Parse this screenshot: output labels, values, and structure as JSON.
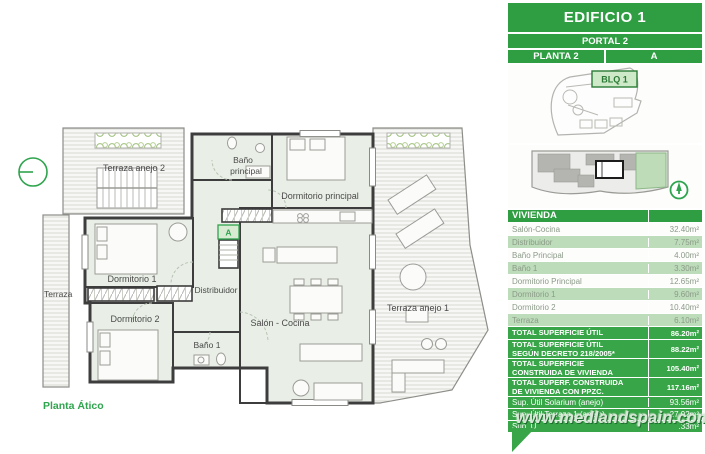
{
  "watermark": "www.medlandspain.com",
  "plan": {
    "title": "Planta Ático",
    "labels": {
      "terraza_anejo_2": "Terraza anejo 2",
      "bano_principal_1": "Baño",
      "bano_principal_2": "principal",
      "dormitorio_principal": "Dormitorio principal",
      "dormitorio_1": "Dormitorio 1",
      "terraza": "Terraza",
      "dormitorio_2": "Dormitorio 2",
      "distribuidor": "Distribuidor",
      "bano_1": "Baño 1",
      "salon_cocina": "Salón - Cocina",
      "terraza_anejo_1": "Terraza anejo 1",
      "stair_marker": "A"
    }
  },
  "panel": {
    "building": "EDIFICIO 1",
    "portal": "PORTAL 2",
    "planta": "PLANTA 2",
    "unit": "A",
    "block": "BLQ 1",
    "table": {
      "header": "VIVIENDA",
      "rooms": [
        {
          "label": "Salón-Cocina",
          "value": "32.40m²"
        },
        {
          "label": "Distribuidor",
          "value": "7.75m²"
        },
        {
          "label": "Baño Principal",
          "value": "4.00m²"
        },
        {
          "label": "Baño 1",
          "value": "3.30m²"
        },
        {
          "label": "Dormitorio Principal",
          "value": "12.65m²"
        },
        {
          "label": "Dormitorio 1",
          "value": "9.60m²"
        },
        {
          "label": "Dormitorio 2",
          "value": "10.40m²"
        },
        {
          "label": "Terraza",
          "value": "6.10m²"
        }
      ],
      "totals": [
        {
          "label": "TOTAL SUPERFICIE ÚTIL",
          "value": "86.20m²"
        },
        {
          "label": "TOTAL SUPERFICIE ÚTIL SEGÚN DECRETO 218/2005*",
          "value": "88.22m²"
        },
        {
          "label": "TOTAL SUPERFICIE CONSTRUIDA DE VIVIENDA",
          "value": "105.40m²"
        },
        {
          "label": "TOTAL SUPERF. CONSTRUIDA DE VIVIENDA CON PPZC.",
          "value": "117.16m²"
        }
      ],
      "annexes": [
        {
          "label": "Sup. Útil Solarium (anejo)",
          "value": "93.56m²"
        },
        {
          "label": "Sup. Útil Terraza 1 (anejo)",
          "value": "27.92m²"
        },
        {
          "label": "Sup. Ú",
          "value": ".33m²"
        }
      ]
    },
    "colors": {
      "panel_green": "#3fae4c",
      "bar_green": "#2f9e42",
      "total_row_green": "#38a648",
      "row_light_green": "#bcdcba",
      "row_text_gray": "#8c9a88",
      "accent_green": "#2fa44e"
    }
  }
}
